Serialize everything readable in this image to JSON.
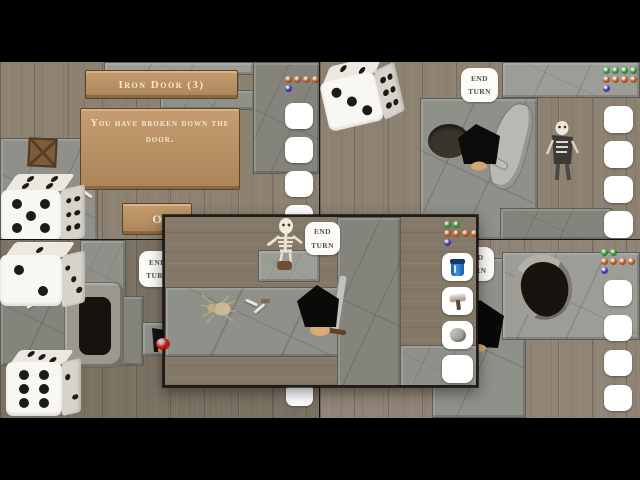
{
  "gem_colors": {
    "orange": "#d2591c",
    "green": "#2fa12f",
    "blue": "#3b35cc",
    "red": "#d60f0f"
  },
  "top_left": {
    "dialog_title": "Iron Door (3)",
    "dialog_message": "You have broken down the door.",
    "ok_label": "O",
    "gems": [
      {
        "color": "orange",
        "count": 4
      },
      {
        "color": "blue",
        "count": 1
      }
    ],
    "die": {
      "front": 5,
      "side": 6,
      "top": 4
    },
    "slots": 4
  },
  "top_right": {
    "end_turn": "END TURN",
    "gems": [
      {
        "color": "green",
        "count": 4
      },
      {
        "color": "orange",
        "count": 4
      },
      {
        "color": "blue",
        "count": 1
      }
    ],
    "die": {
      "front": 3,
      "side": 6,
      "top": 2
    },
    "slots": 4
  },
  "bottom_left": {
    "end_turn": "END TURN",
    "gems": [
      {
        "color": "red",
        "count": 1
      }
    ],
    "dice": [
      {
        "front": 2,
        "side": 3,
        "top": 1
      },
      {
        "front": 6,
        "side": 2,
        "top": 3
      }
    ],
    "slots": 4
  },
  "bottom_right": {
    "end_turn": "END TURN",
    "gems": [
      {
        "color": "green",
        "count": 2
      },
      {
        "color": "orange",
        "count": 4
      },
      {
        "color": "blue",
        "count": 1
      }
    ],
    "slots": 4
  },
  "popup": {
    "end_turn": "END TURN",
    "gems": [
      {
        "color": "green",
        "count": 2
      },
      {
        "color": "orange",
        "count": 4
      },
      {
        "color": "blue",
        "count": 1
      }
    ],
    "items": [
      "potion",
      "hammer",
      "stone",
      "empty"
    ]
  }
}
